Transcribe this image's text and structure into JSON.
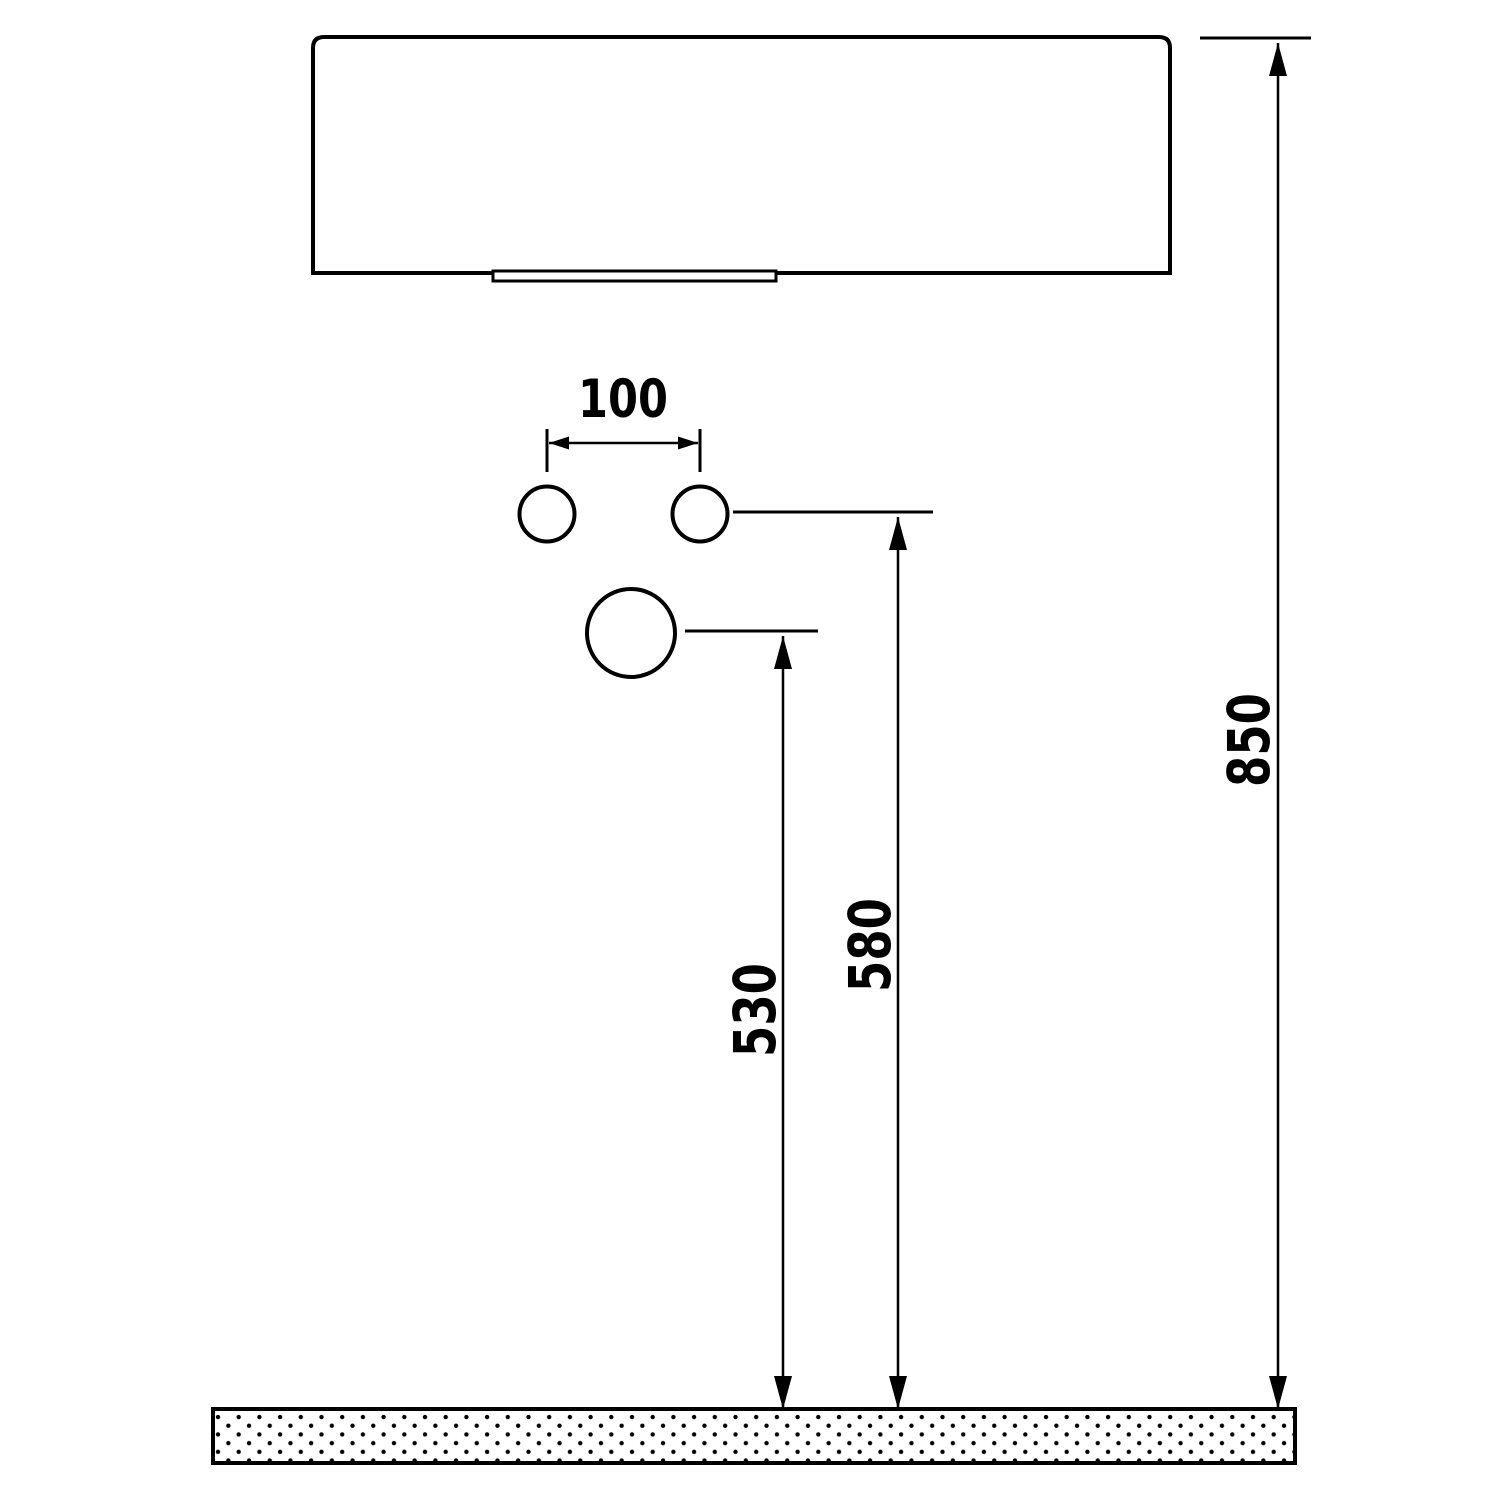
{
  "drawing": {
    "title": "washbasin-installation-dimension-drawing",
    "colors": {
      "line": "#000000",
      "background": "#ffffff",
      "fill": "#ffffff"
    },
    "dimensions": [
      {
        "id": "faucet-hole-spacing",
        "label": "100",
        "orientation": "horizontal"
      },
      {
        "id": "drain-hole-to-floor",
        "label": "530",
        "orientation": "vertical"
      },
      {
        "id": "faucet-holes-to-floor",
        "label": "580",
        "orientation": "vertical"
      },
      {
        "id": "basin-top-to-floor",
        "label": "850",
        "orientation": "vertical"
      }
    ]
  }
}
